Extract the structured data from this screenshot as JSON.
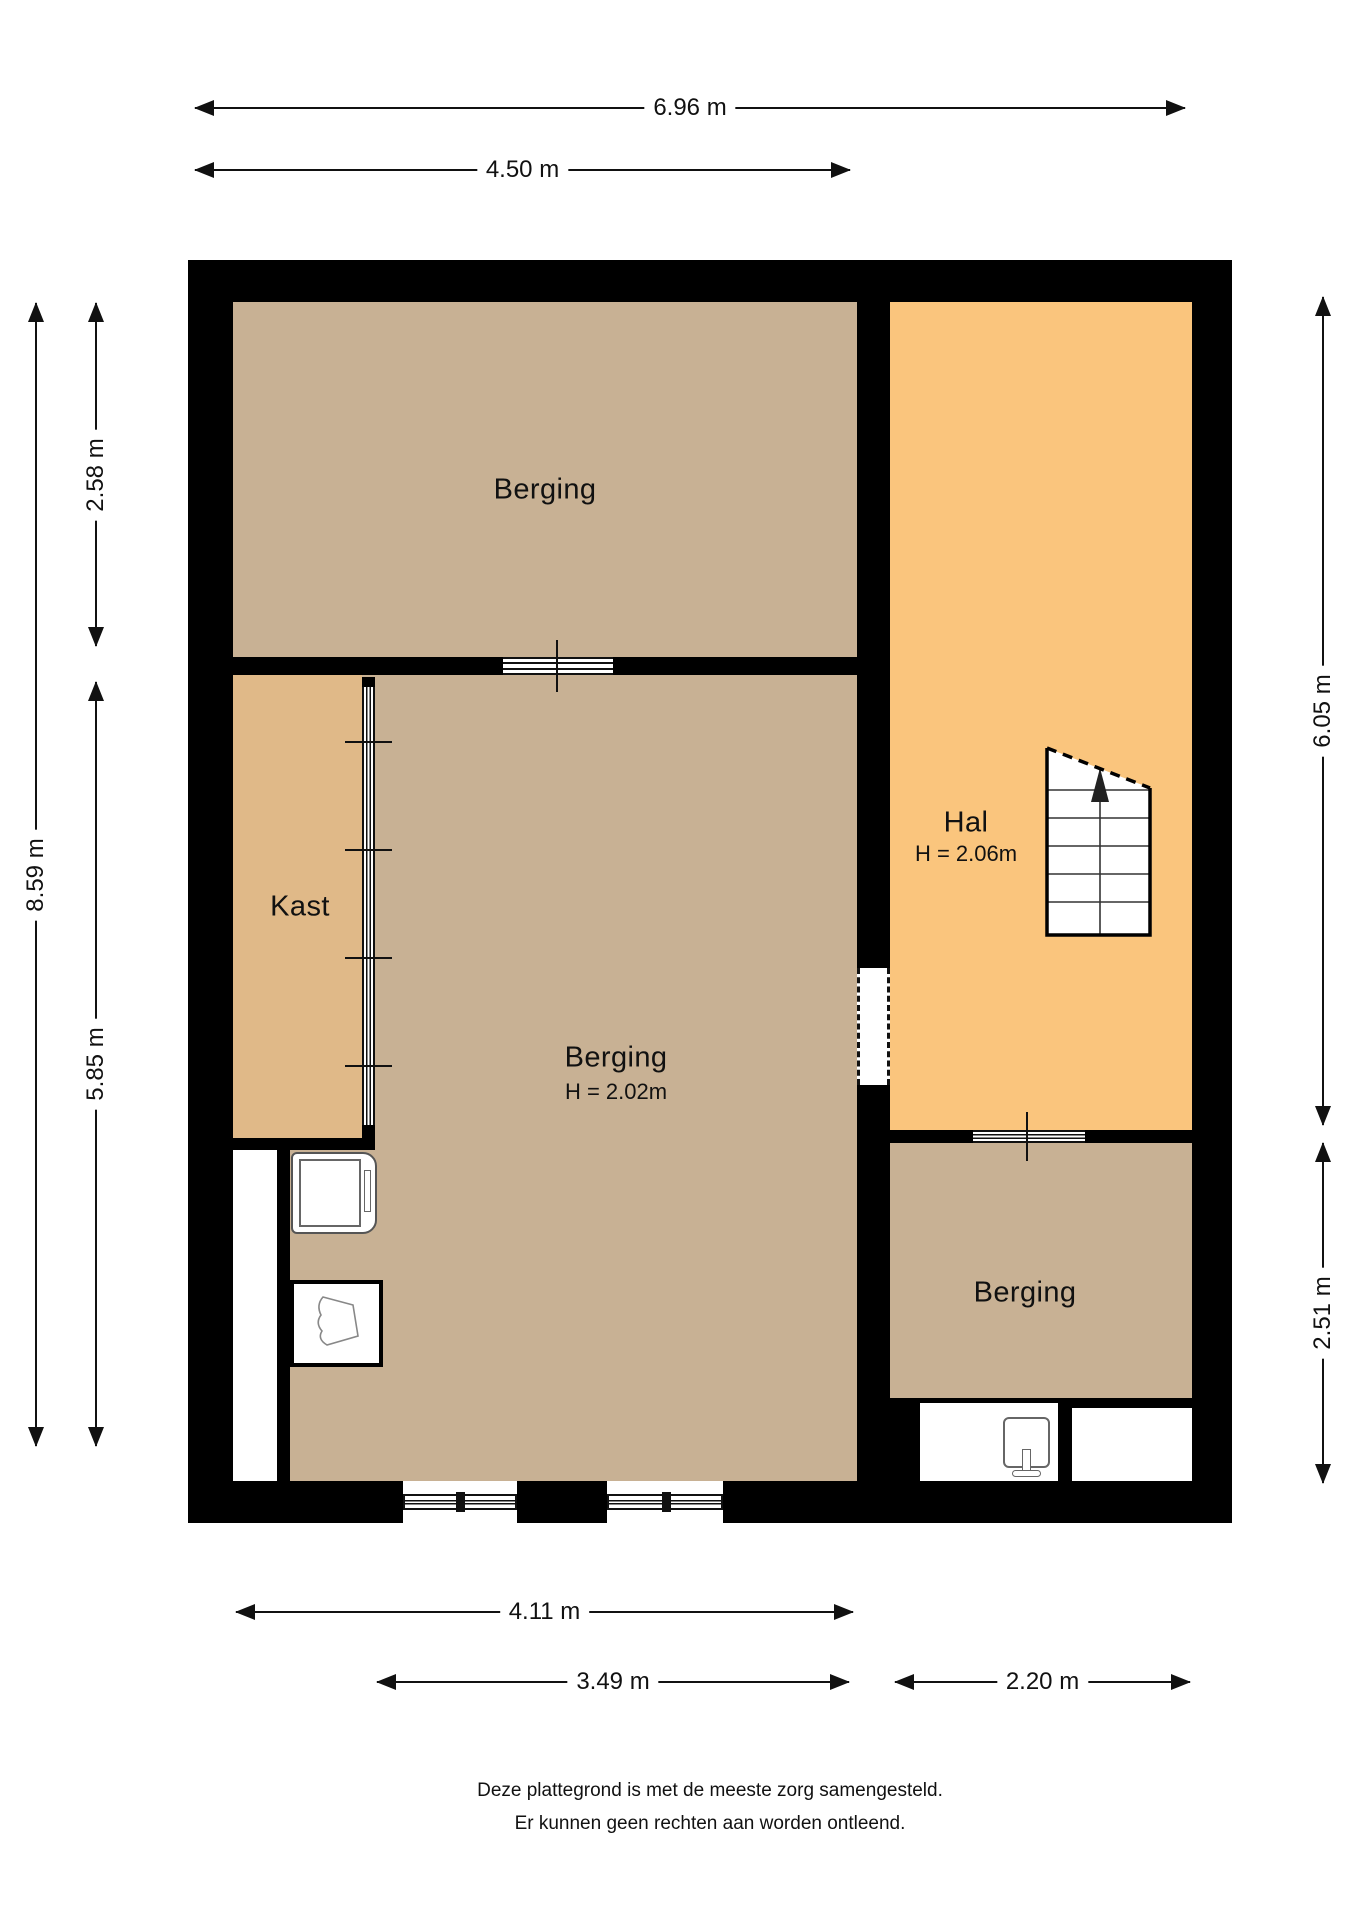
{
  "rooms": {
    "berging_top": {
      "label": "Berging"
    },
    "kast": {
      "label": "Kast"
    },
    "berging_middle": {
      "label": "Berging",
      "height": "H = 2.02m"
    },
    "hal": {
      "label": "Hal",
      "height": "H = 2.06m"
    },
    "berging_bottom": {
      "label": "Berging"
    }
  },
  "dimensions": {
    "top_total": "6.96 m",
    "top_left_section": "4.50 m",
    "bottom_inner": "4.11 m",
    "bottom_left": "3.49 m",
    "bottom_right": "2.20 m",
    "left_total": "8.59 m",
    "left_top": "2.58 m",
    "left_bottom": "5.85 m",
    "right_top": "6.05 m",
    "right_bottom": "2.51 m"
  },
  "footer": {
    "line1": "Deze plattegrond is met de meeste zorg samengesteld.",
    "line2": "Er kunnen geen rechten aan worden ontleend."
  },
  "colors": {
    "wall": "#000000",
    "berging": "#c8b194",
    "kast": "#e0b988",
    "hal": "#fac57d",
    "line": "#111111"
  }
}
